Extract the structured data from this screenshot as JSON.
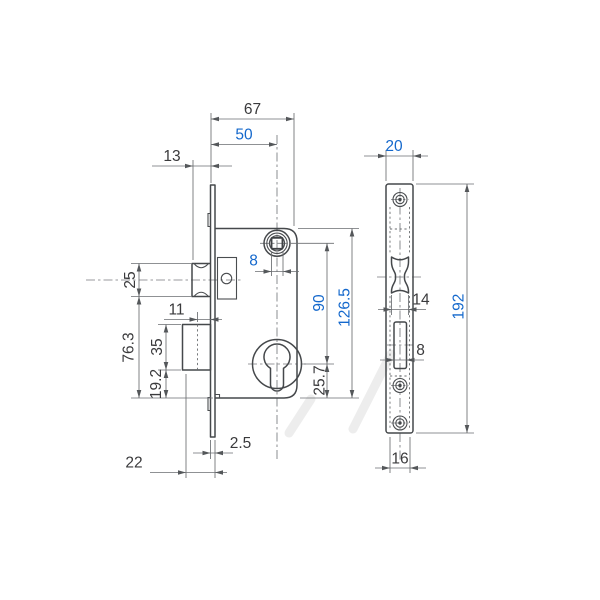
{
  "drawing": {
    "accent_blue": "#1468cc",
    "line_color": "#45484b",
    "dim_line_color": "#6b6e71",
    "background": "#ffffff",
    "side_view": {
      "dim_67": "67",
      "dim_50": "50",
      "dim_13": "13",
      "dim_8_spindle": "8",
      "dim_25": "25",
      "dim_76_3": "76.3",
      "dim_11": "11",
      "dim_35": "35",
      "dim_19_2": "19.2",
      "dim_90": "90",
      "dim_25_7": "25.7",
      "dim_126_5": "126.5",
      "dim_2_5": "2.5",
      "dim_22": "22"
    },
    "front_view": {
      "dim_20": "20",
      "dim_14": "14",
      "dim_8_slot": "8",
      "dim_16": "16",
      "dim_192": "192"
    }
  }
}
